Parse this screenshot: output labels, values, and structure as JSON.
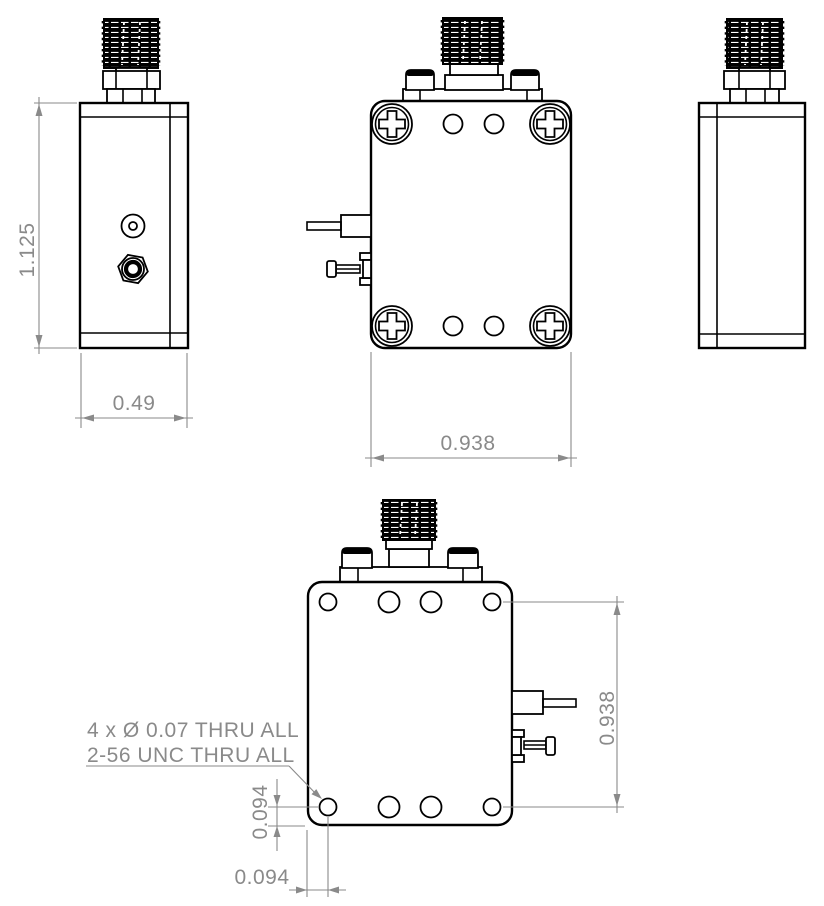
{
  "drawing": {
    "background_color": "#ffffff",
    "line_color": "#000000",
    "dimension_color": "#8a8a8a",
    "views": {
      "left_side": {
        "height_dim": "1.125",
        "width_dim": "0.49"
      },
      "front": {
        "width_dim": "0.938"
      },
      "right_side": {},
      "back": {
        "height_dim": "0.938",
        "hole_offset_vertical_dim": "0.094",
        "hole_offset_horizontal_dim": "0.094",
        "hole_note_line1": "4 x Ø 0.07 THRU ALL",
        "hole_note_line2": "2-56 UNC THRU ALL"
      }
    }
  }
}
